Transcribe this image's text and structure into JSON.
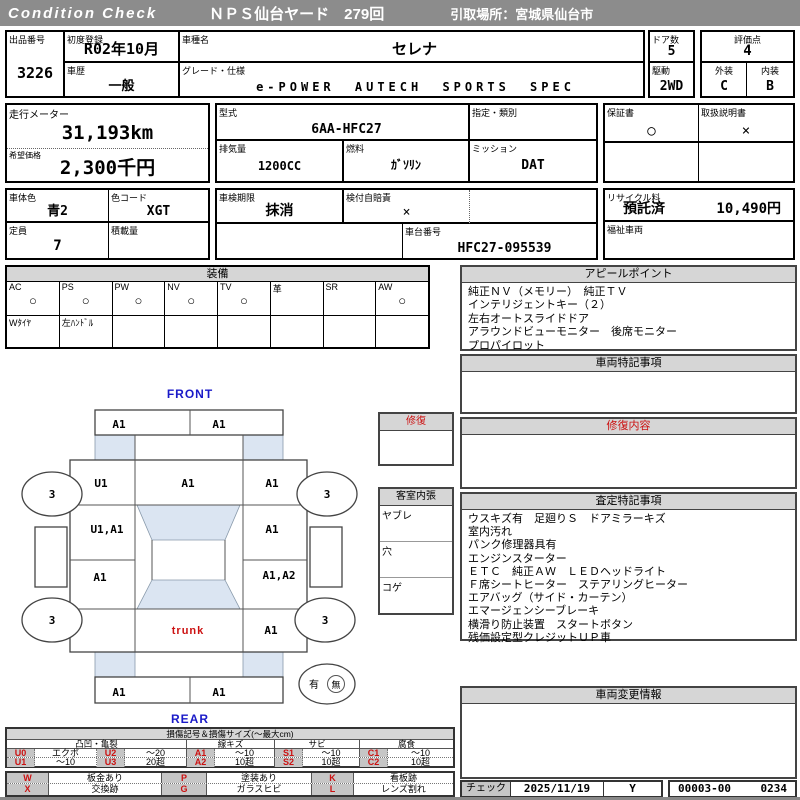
{
  "colors": {
    "header_bg": "#8c8c8c",
    "section_header_bg": "#d6d6d6",
    "legend_code_bg": "#c6c6c6",
    "accent_red": "#cc1111",
    "label_blue": "#1a1ac8",
    "diagram_shade": "#dbe5f2"
  },
  "header": {
    "brand": "Condition Check",
    "title": "ＮＰＳ仙台ヤード　279回",
    "pickup_location": "引取場所：宮城県仙台市"
  },
  "fields": {
    "lot": {
      "label": "出品番号",
      "value": "3226"
    },
    "first_reg": {
      "label": "初度登録",
      "value": "R02年10月"
    },
    "history": {
      "label": "車歴",
      "value": "一般"
    },
    "model": {
      "label": "車種名",
      "value": "セレナ"
    },
    "grade": {
      "label": "グレード・仕様",
      "value": "e-POWER AUTECH SPORTS SPEC"
    },
    "doors": {
      "label": "ドア数",
      "value": "5"
    },
    "drive": {
      "label": "駆動",
      "value": "2WD"
    },
    "score": {
      "label": "評価点",
      "value": "4"
    },
    "exterior": {
      "label": "外装",
      "value": "C"
    },
    "interior": {
      "label": "内装",
      "value": "B"
    },
    "odometer": {
      "label": "走行メーター",
      "value": "31,193km"
    },
    "price": {
      "label": "希望価格",
      "value": "2,300千円"
    },
    "model_code": {
      "label": "型式",
      "value": "6AA-HFC27"
    },
    "designation": {
      "label": "指定・類別",
      "value": ""
    },
    "displacement": {
      "label": "排気量",
      "value": "1200CC"
    },
    "fuel": {
      "label": "燃料",
      "value": "ｶﾞｿﾘﾝ"
    },
    "mission": {
      "label": "ミッション",
      "value": "DAT"
    },
    "warranty": {
      "label": "保証書",
      "value": "○"
    },
    "manual": {
      "label": "取扱説明書",
      "value": "×"
    },
    "body_color": {
      "label": "車体色",
      "value": "青2"
    },
    "color_code": {
      "label": "色コード",
      "value": "XGT"
    },
    "inspection": {
      "label": "車検期限",
      "value": "抹消"
    },
    "insurance": {
      "label": "検付自賠責",
      "value": "×"
    },
    "capacity": {
      "label": "定員",
      "value": "7"
    },
    "load": {
      "label": "積載量",
      "value": ""
    },
    "chassis": {
      "label": "車台番号",
      "value": "HFC27-095539"
    },
    "recycle": {
      "label": "リサイクル料",
      "status": "預託済",
      "fee": "10,490円"
    },
    "welfare": {
      "label": "福祉車両",
      "value": ""
    }
  },
  "equipment": {
    "title": "装備",
    "items": [
      {
        "label": "AC",
        "mark": "○",
        "note": "Wﾀｲﾔ"
      },
      {
        "label": "PS",
        "mark": "○",
        "note": "左ﾊﾝﾄﾞﾙ"
      },
      {
        "label": "PW",
        "mark": "○",
        "note": ""
      },
      {
        "label": "NV",
        "mark": "○",
        "note": ""
      },
      {
        "label": "TV",
        "mark": "○",
        "note": ""
      },
      {
        "label": "革",
        "mark": "",
        "note": ""
      },
      {
        "label": "SR",
        "mark": "",
        "note": ""
      },
      {
        "label": "AW",
        "mark": "○",
        "note": ""
      }
    ]
  },
  "appeal": {
    "title": "アピールポイント",
    "lines": [
      "純正ＮＶ（メモリー）　純正ＴＶ",
      "インテリジェントキー（２）",
      "左右オートスライドドア",
      "アラウンドビューモニター　後席モニター",
      "プロパイロット"
    ]
  },
  "vehicle_notes": {
    "title": "車両特記事項"
  },
  "repair_details": {
    "title": "修復内容"
  },
  "assessment": {
    "title": "査定特記事項",
    "lines": [
      "ウスキズ有　足廻りＳ　ドアミラーキズ",
      "室内汚れ",
      "パンク修理器具有",
      "エンジンスターター",
      "ＥＴＣ　純正ＡＷ　ＬＥＤヘッドライト",
      "Ｆ席シートヒーター　ステアリングヒーター",
      "エアバッグ（サイド・カーテン）",
      "エマージェンシーブレーキ",
      "横滑り防止装置　スタートボタン",
      "残価設定型クレジットＵＰ車"
    ]
  },
  "change_info": {
    "title": "車両変更情報"
  },
  "footer": {
    "check_label": "チェック",
    "date": "2025/11/19",
    "mark": "Y",
    "code": "00003-00",
    "number": "0234"
  },
  "diagram": {
    "front_label": "FRONT",
    "rear_label": "REAR",
    "repair_box_title": "修復",
    "interior_box": {
      "title": "客室内張",
      "rows": [
        "ヤブレ",
        "穴",
        "コゲ"
      ]
    },
    "panels": {
      "front_bumper_left": "A1",
      "front_bumper_right": "A1",
      "front_fender_left": "U1",
      "cowl_center": "A1",
      "front_fender_right": "A1",
      "front_door_left": "U1,A1",
      "front_door_right": "A1",
      "rear_door_left": "A1",
      "rear_quarter_right": "A1,A2",
      "rear_quarter_left": "",
      "trunk_label": "trunk",
      "trunk_side_right": "A1",
      "rear_bumper_left": "A1",
      "rear_bumper_right": "A1"
    },
    "wheels": {
      "front_left": "3",
      "front_right": "3",
      "rear_left": "3",
      "rear_right": "3"
    },
    "spare_tire": {
      "present_label": "有",
      "absent_label": "無"
    }
  },
  "legend": {
    "title": "損傷記号＆損傷サイズ(〜最大cm)",
    "groups": [
      "凸凹・亀裂",
      "線キズ",
      "サビ",
      "腐食"
    ],
    "rows": [
      [
        {
          "code": "U0",
          "size": "エクボ"
        },
        {
          "code": "U2",
          "size": "〜20"
        },
        {
          "code": "A1",
          "size": "〜10"
        },
        {
          "code": "S1",
          "size": "〜10"
        },
        {
          "code": "C1",
          "size": "〜10"
        }
      ],
      [
        {
          "code": "U1",
          "size": "〜10"
        },
        {
          "code": "U3",
          "size": "20超"
        },
        {
          "code": "A2",
          "size": "10超"
        },
        {
          "code": "S2",
          "size": "10超"
        },
        {
          "code": "C2",
          "size": "10超"
        }
      ]
    ],
    "marks": [
      [
        {
          "code": "W",
          "desc": "板金あり"
        },
        {
          "code": "P",
          "desc": "塗装あり"
        },
        {
          "code": "K",
          "desc": "看板跡"
        }
      ],
      [
        {
          "code": "X",
          "desc": "交換跡"
        },
        {
          "code": "G",
          "desc": "ガラスヒビ"
        },
        {
          "code": "L",
          "desc": "レンズ割れ"
        }
      ]
    ]
  }
}
